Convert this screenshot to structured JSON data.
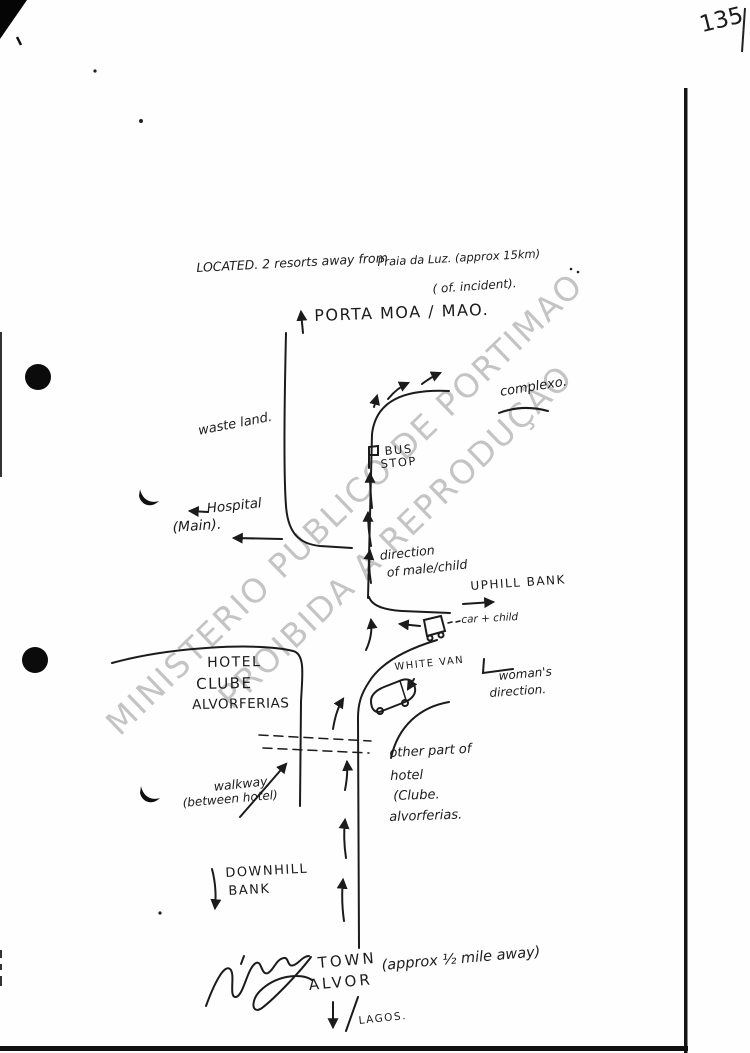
{
  "document": {
    "page_number": "135",
    "watermark": {
      "line1": "MINISTERIO PUBLICO DE PORTIMAO",
      "line2": "PROIBIDA A REPRODUÇÃO"
    }
  },
  "map": {
    "header": {
      "located_a": "LOCATED. 2 resorts away from",
      "located_b": "Praia da Luz. (approx 15km)",
      "located_c": "( of. incident).",
      "porta_label": "PORTA MOA / MAO."
    },
    "labels": {
      "complexo": "complexo.",
      "waste_land": "waste land.",
      "bus": "BUS",
      "stop": "STOP",
      "hospital": "Hospital",
      "hospital_main": "(Main).",
      "direction_1": "direction",
      "direction_2": "of male/child",
      "uphill_bank": "UPHILL BANK",
      "car_child": "car + child",
      "hotel_1": "HOTEL",
      "hotel_2": "CLUBE",
      "hotel_3": "ALVORFERIAS",
      "white_van": "WHITE VAN",
      "womans_1": "woman's",
      "womans_2": "direction.",
      "other_part_1": "other part of",
      "other_part_2": "hotel",
      "other_part_3": "(Clube.",
      "other_part_4": "alvorferias.",
      "walkway_1": "walkway,",
      "walkway_2": "(between hotel)",
      "downhill_1": "DOWNHILL",
      "downhill_2": "BANK"
    },
    "footer": {
      "town_1": "TOWN",
      "town_2": "ALVOR",
      "approx": "(approx ½ mile away)",
      "lagos": "LAGOS."
    },
    "icons": {
      "car": "car-icon",
      "van": "van-icon",
      "bus_stop_sign": "bus-stop-sign-icon",
      "hole_punch": "hole-punch",
      "arrows": "hand-drawn arrow strokes"
    },
    "colors": {
      "ink": "#1b1b1b",
      "watermark_gray": "#8f8f8f"
    }
  }
}
